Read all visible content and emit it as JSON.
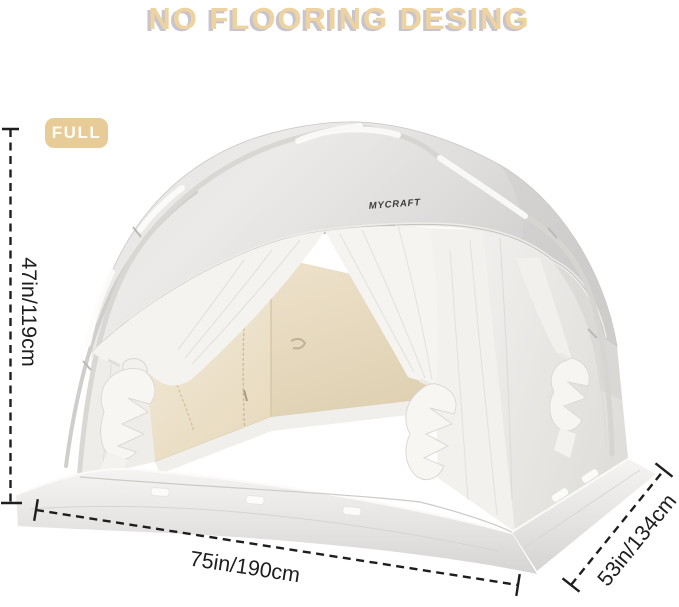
{
  "title": "NO FLOORING DESING",
  "badge": {
    "label": "FULL"
  },
  "brand": {
    "label": "MYCRAFT"
  },
  "dimensions": {
    "height_label": "47in/119cm",
    "width_label": "75in/190cm",
    "depth_label": "53in/134cm"
  },
  "colors": {
    "title_text": "#eed2a0",
    "badge_bg": "#e8cc97",
    "badge_text": "#fffdf8",
    "dimension_lines": "#1e1e1e",
    "canopy_light": "#eceae8",
    "canopy_dark": "#cecccb",
    "interior_wall_beige": "#e8dbc0",
    "curtain_white": "#f6f4f2",
    "background": "#ffffff"
  }
}
